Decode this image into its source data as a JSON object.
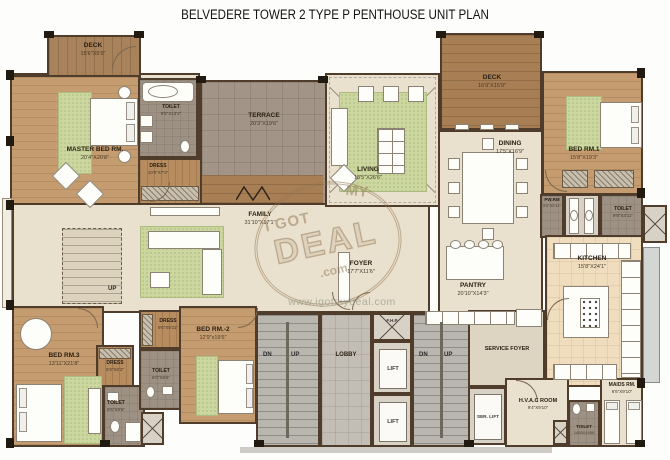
{
  "title": "BELVEDERE TOWER 2 TYPE P PENTHOUSE UNIT PLAN",
  "watermark": {
    "top": "I GOT",
    "mid": "MY",
    "main": "DEAL",
    "com": ".com",
    "url": "www.igotmydeal.com"
  },
  "stairs": {
    "dn": "DN",
    "up": "UP"
  },
  "rooms": {
    "deck_left": {
      "name": "DECK",
      "dims": "15'6\"X5'9\""
    },
    "master_bed": {
      "name": "MASTER BED RM.",
      "dims": "20'4\"X20'8\""
    },
    "toilet_master": {
      "name": "TOILET",
      "dims": "9'8\"X13'2\""
    },
    "dress_master": {
      "name": "DRESS",
      "dims": "10'0\"X7'3\""
    },
    "terrace": {
      "name": "TERRACE",
      "dims": "20'3\"X19'6\""
    },
    "living": {
      "name": "LIVING",
      "dims": "18'5\"X26'6\""
    },
    "deck_right": {
      "name": "DECK",
      "dims": "16'9\"X15'9\""
    },
    "dining": {
      "name": "DINING",
      "dims": "17'5\"X16'9\""
    },
    "bed1": {
      "name": "BED RM.1",
      "dims": "15'8\"X19'3\""
    },
    "pw_rm": {
      "name": "PW.RM",
      "dims": "5'0\"X5'11\""
    },
    "toilet_bed1": {
      "name": "TOILET",
      "dims": "9'9\"X3'11\""
    },
    "kitchen": {
      "name": "KITCHEN",
      "dims": "15'8\"X24'1\""
    },
    "family": {
      "name": "FAMILY",
      "dims": "31'10\"X17'1\""
    },
    "foyer": {
      "name": "FOYER",
      "dims": "17'7\"X11'6\""
    },
    "pantry": {
      "name": "PANTRY",
      "dims": "20'10\"X14'3\""
    },
    "service_foyer": {
      "name": "SERVICE FOYER",
      "dims": ""
    },
    "hvac": {
      "name": "H.V.A.C ROOM",
      "dims": "9'4\"X9'10\""
    },
    "maids": {
      "name": "MAIDS RM.",
      "dims": "6'6\"X9'10\""
    },
    "toilet_service": {
      "name": "TOILET",
      "dims": "1400X1950"
    },
    "bed3": {
      "name": "BED RM.3",
      "dims": "13'11\"X21'8\""
    },
    "dress_bed3": {
      "name": "DRESS",
      "dims": "6'8\"X6'2\""
    },
    "toilet_bed3": {
      "name": "TOILET",
      "dims": "6'5\"X9'6\""
    },
    "dress_bed2": {
      "name": "DRESS",
      "dims": "9'5\"X5'11\""
    },
    "bed2": {
      "name": "BED RM.-2",
      "dims": "12'9\"x19'6\""
    },
    "toilet_bed2": {
      "name": "TOILET",
      "dims": "6'0\"X9'6\""
    },
    "lobby": {
      "name": "LOBBY",
      "dims": ""
    },
    "lift": {
      "name": "LIFT",
      "dims": ""
    },
    "ser_lift": {
      "name": "SER. LIFT",
      "dims": ""
    },
    "fhp": {
      "name": "F.H.P",
      "dims": ""
    }
  }
}
